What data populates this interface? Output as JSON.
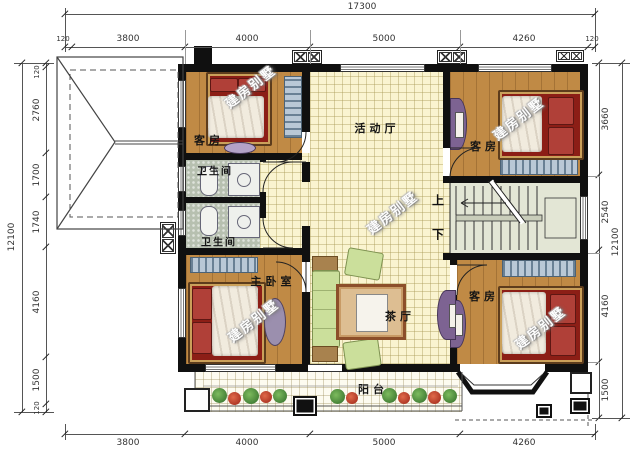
{
  "watermark": "建房别墅",
  "rooms": {
    "guest_tl": "客房",
    "guest_tr": "客房",
    "guest_br": "客房",
    "activity_hall": "活动厅",
    "bath_upper": "卫生间",
    "bath_lower": "卫生间",
    "master": "主卧室",
    "tea_hall": "茶厅",
    "balcony": "阳台",
    "stair_up": "上",
    "stair_down": "下"
  },
  "dimensions": {
    "top_total": "17300",
    "top": [
      "120",
      "3800",
      "4000",
      "5000",
      "4260",
      "120"
    ],
    "bottom": [
      "3800",
      "4000",
      "5000",
      "4260"
    ],
    "left_total": "12100",
    "left": [
      "120",
      "2760",
      "1700",
      "1740",
      "4160",
      "1500",
      "120"
    ],
    "right_total": "12100",
    "right": [
      "3660",
      "2540",
      "4160",
      "1500"
    ]
  },
  "colors": {
    "wall": "#101010",
    "wood_floor": "#c08a45",
    "tile_floor": "#faf4d0",
    "bath_floor": "#b7c0b0",
    "stair_floor": "#e3e6d5",
    "balcony_floor": "#fdfbf0",
    "bed_red": "#8c1e16",
    "sofa_green": "#cbdf9b",
    "furniture_purple": "#7d6392",
    "wardrobe_blue": "#b9c8d6"
  }
}
